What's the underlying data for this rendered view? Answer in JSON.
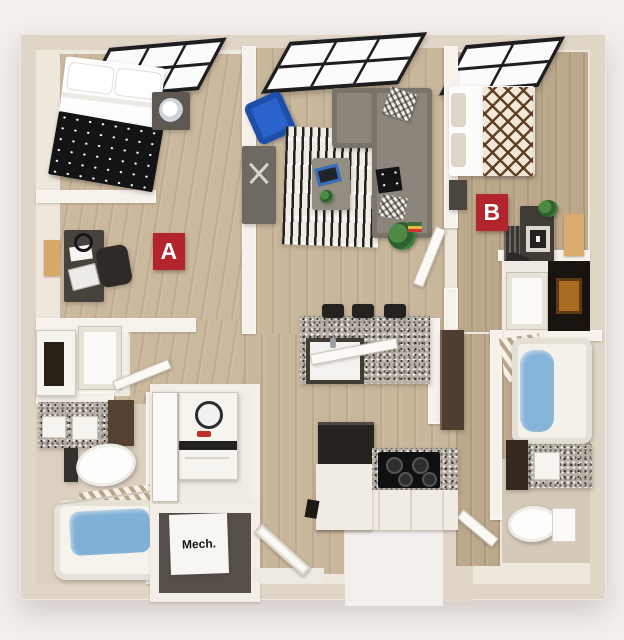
{
  "floorplan": {
    "badge_a": "A",
    "badge_b": "B",
    "mech_label": "Mech.",
    "colors": {
      "background": "#f3efed",
      "outer_wall": "#e0d6c8",
      "inner_wall_face": "#f6f1ea",
      "wood_floor_light": "#c9b79c",
      "wood_floor_tan": "#bca98c",
      "badge_red": "#b3242d",
      "armchair_blue": "#2a63cc",
      "sofa_gray": "#8b857b",
      "bath_water_blue": "#82b2d8",
      "granite_counter": "#b4aea5"
    }
  }
}
